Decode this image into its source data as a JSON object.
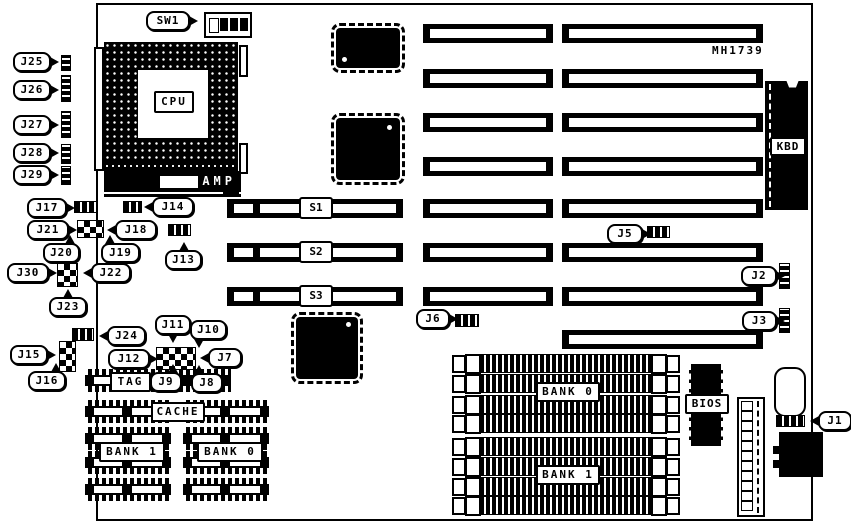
{
  "part_number": "MH1739",
  "colors": {
    "ink": "#000000",
    "paper": "#ffffff"
  },
  "labels": {
    "sw1": "SW1",
    "cpu": "CPU",
    "amp": "AMP",
    "kbd": "KBD",
    "bios": "BIOS",
    "tag": "TAG",
    "cache": "CACHE",
    "cache_bank1": "BANK 1",
    "cache_bank0": "BANK 0",
    "simm_bank0": "BANK 0",
    "simm_bank1": "BANK 1",
    "s1": "S1",
    "s2": "S2",
    "s3": "S3",
    "j1": "J1",
    "j2": "J2",
    "j3": "J3",
    "j5": "J5",
    "j6": "J6",
    "j7": "J7",
    "j8": "J8",
    "j9": "J9",
    "j10": "J10",
    "j11": "J11",
    "j12": "J12",
    "j13": "J13",
    "j14": "J14",
    "j15": "J15",
    "j16": "J16",
    "j17": "J17",
    "j18": "J18",
    "j19": "J19",
    "j20": "J20",
    "j21": "J21",
    "j22": "J22",
    "j23": "J23",
    "j24": "J24",
    "j25": "J25",
    "j26": "J26",
    "j27": "J27",
    "j28": "J28",
    "j29": "J29",
    "j30": "J30"
  }
}
